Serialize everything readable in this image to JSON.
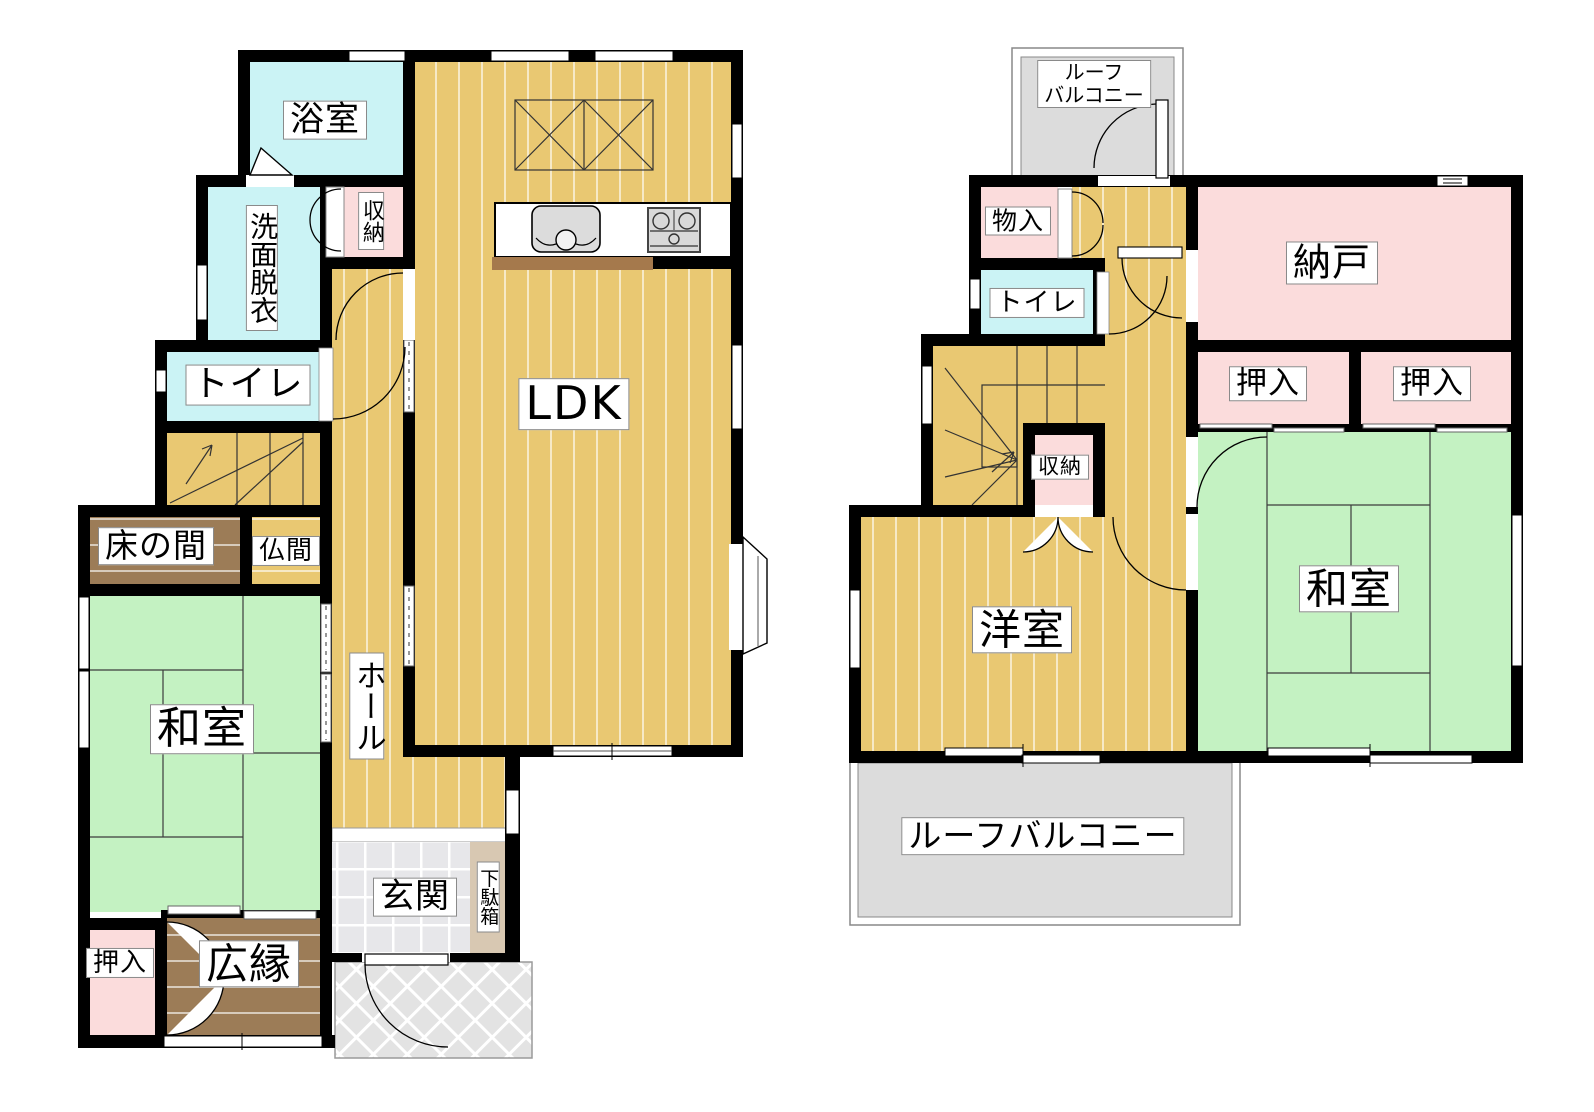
{
  "floor1": {
    "labels": {
      "bath": "浴室",
      "washroom": "洗面脱衣",
      "storage": "収納",
      "toilet": "トイレ",
      "tokonoma": "床の間",
      "butsuma": "仏間",
      "japanese_room": "和室",
      "hall": "ホール",
      "ldk": "LDK",
      "entrance": "玄関",
      "shoe_cabinet": "下駄箱",
      "closet": "押入",
      "veranda": "広縁"
    }
  },
  "floor2": {
    "labels": {
      "roof_balcony_line1": "ルーフ",
      "roof_balcony_line2": "バルコニー",
      "small_storage": "物入",
      "toilet": "トイレ",
      "storeroom": "納戸",
      "closet_left": "押入",
      "closet_right": "押入",
      "storage": "収納",
      "western_room": "洋室",
      "japanese_room": "和室",
      "roof_balcony": "ルーフバルコニー"
    }
  },
  "colors": {
    "wood": "#e9c872",
    "tatami": "#c4f2c2",
    "water": "#cbf3f5",
    "closet_pink": "#fbdcdc",
    "brown": "#9c7c57",
    "balcony_gray": "#dcdcdc",
    "tile": "#e7e7ea",
    "porch": "#e3e3e3",
    "shoe_cabinet": "#d8c8b2",
    "counter_ledge": "#a5794c",
    "wall": "#000000"
  }
}
